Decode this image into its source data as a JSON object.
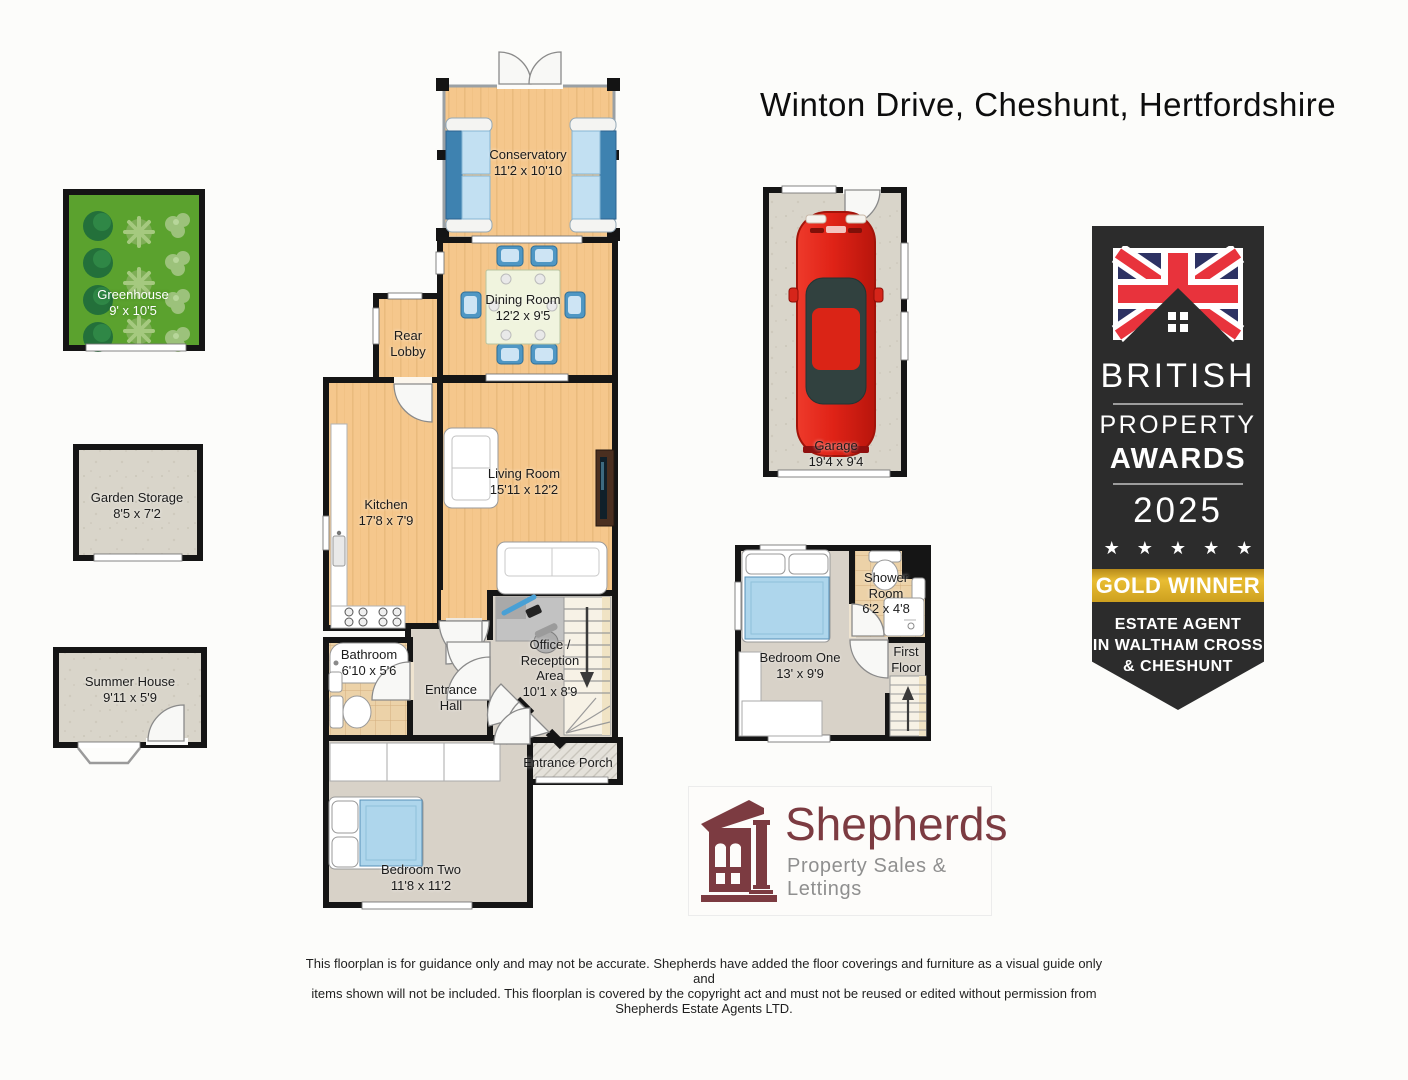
{
  "title": "Winton Drive, Cheshunt, Hertfordshire",
  "rooms": {
    "conservatory": {
      "name": "Conservatory",
      "dims": "11'2 x 10'10"
    },
    "dining_room": {
      "name": "Dining Room",
      "dims": "12'2 x 9'5"
    },
    "rear_lobby": {
      "name": "Rear Lobby"
    },
    "kitchen": {
      "name": "Kitchen",
      "dims": "17'8 x 7'9"
    },
    "living_room": {
      "name": "Living Room",
      "dims": "15'11 x 12'2"
    },
    "bathroom": {
      "name": "Bathroom",
      "dims": "6'10 x 5'6"
    },
    "entrance_hall": {
      "name": "Entrance Hall"
    },
    "office": {
      "name": "Office / Reception Area",
      "dims": "10'1 x 8'9"
    },
    "entrance_porch": {
      "name": "Entrance Porch"
    },
    "bedroom_two": {
      "name": "Bedroom Two",
      "dims": "11'8 x 11'2"
    },
    "bedroom_one": {
      "name": "Bedroom One",
      "dims": "13' x 9'9"
    },
    "shower_room": {
      "name": "Shower Room",
      "dims": "6'2 x 4'8"
    },
    "first_floor": {
      "name": "First Floor"
    },
    "garage": {
      "name": "Garage",
      "dims": "19'4 x 9'4"
    },
    "greenhouse": {
      "name": "Greenhouse",
      "dims": "9' x 10'5"
    },
    "garden_storage": {
      "name": "Garden Storage",
      "dims": "8'5 x 7'2"
    },
    "summer_house": {
      "name": "Summer House",
      "dims": "9'11 x 5'9"
    }
  },
  "badge": {
    "line1": "BRITISH",
    "line2": "PROPERTY",
    "line3": "AWARDS",
    "year": "2025",
    "stars": "★ ★ ★ ★ ★",
    "award": "GOLD WINNER",
    "sub1": "ESTATE AGENT",
    "sub2": "IN WALTHAM CROSS",
    "sub3": "& CHESHUNT"
  },
  "logo": {
    "name": "Shepherds",
    "tagline": "Property Sales &  Lettings"
  },
  "disclaimer": {
    "lines": [
      "This floorplan is for guidance only and may not be accurate. Shepherds have added the floor coverings and furniture as a visual guide only and",
      "items shown will not be included. This floorplan is covered by the copyright act and must not be reused or edited without permission from",
      "Shepherds Estate Agents LTD."
    ]
  },
  "colors": {
    "wall": "#151515",
    "wood": "#f5c78c",
    "carpet": "#d8d2c8",
    "tile": "#ecd2a8",
    "accent_red": "#e8333c",
    "accent_navy": "#2d3263",
    "gold": "#d4a72c",
    "maroon": "#7c3b41"
  }
}
